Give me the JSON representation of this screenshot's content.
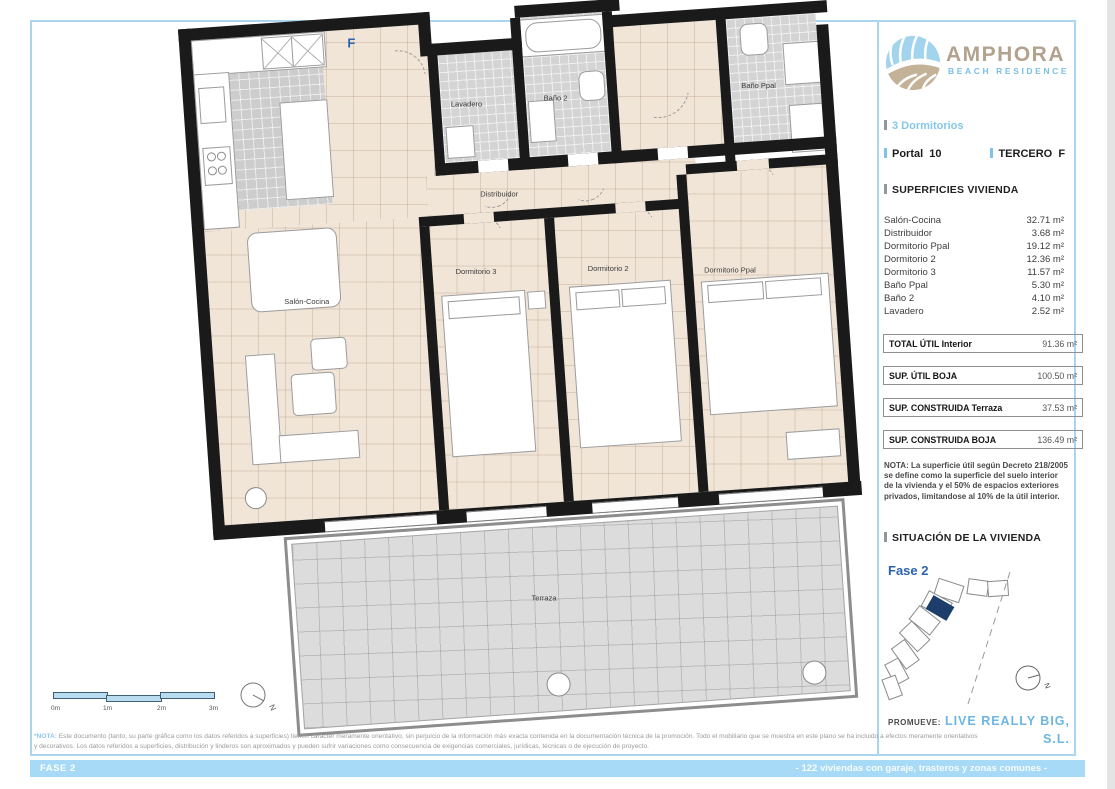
{
  "brand": {
    "name": "AMPHORA",
    "subtitle": "BEACH RESIDENCE"
  },
  "header": {
    "type": "3 Dormitorios",
    "portal": "Portal  10",
    "floor": "TERCERO  F"
  },
  "superficies": {
    "title": "SUPERFICIES VIVIENDA",
    "rows": [
      {
        "label": "Salón-Cocina",
        "value": "32.71 m²"
      },
      {
        "label": "Distribuidor",
        "value": "3.68 m²"
      },
      {
        "label": "Dormitorio Ppal",
        "value": "19.12 m²"
      },
      {
        "label": "Dormitorio 2",
        "value": "12.36 m²"
      },
      {
        "label": "Dormitorio 3",
        "value": "11.57 m²"
      },
      {
        "label": "Baño Ppal",
        "value": "5.30 m²"
      },
      {
        "label": "Baño 2",
        "value": "4.10 m²"
      },
      {
        "label": "Lavadero",
        "value": "2.52 m²"
      }
    ],
    "totals": [
      {
        "label": "TOTAL ÚTIL Interior",
        "value": "91.36 m²"
      },
      {
        "label": "SUP.  ÚTIL BOJA",
        "value": "100.50 m²"
      },
      {
        "label": "SUP. CONSTRUIDA Terraza",
        "value": "37.53 m²"
      },
      {
        "label": "SUP. CONSTRUIDA BOJA",
        "value": "136.49 m²"
      }
    ]
  },
  "nota": "NOTA: La superficie útil según Decreto 218/2005 se define como la superficie del suelo interior de la vivienda y el 50% de espacios exteriores privados, limitandose al 10% de la útil interior.",
  "situacion": {
    "title": "SITUACIÓN DE LA VIVIENDA",
    "fase": "Fase 2"
  },
  "promoter": {
    "label": "PROMUEVE:",
    "name": "LIVE REALLY BIG, S.L."
  },
  "plan": {
    "unit_letter": "F",
    "north_label": "N",
    "rooms": {
      "lavadero": "Lavadero",
      "bano2": "Baño 2",
      "bano_ppal": "Baño Ppal",
      "distribuidor": "Distribuidor",
      "salon_cocina": "Salón-Cocina",
      "dormitorio3": "Dormitorio 3",
      "dormitorio2": "Dormitorio 2",
      "dormitorio_ppal": "Dormitorio Ppal",
      "terraza": "Terraza"
    }
  },
  "scalebar": {
    "labels": [
      "0m",
      "1m",
      "2m",
      "3m"
    ]
  },
  "footer": {
    "note_prefix": "*NOTA:",
    "line1": " Este documento (tanto, su parte gráfica como los datos referidos a superficies) tienen carácter meramente orientativo, sin perjuicio de la información más exacta contenida en la documentación técnica de la promoción. Todo el mobiliario que se muestra en este plano se ha incluido a efectos meramente orientativos",
    "line2": "y decorativos. Los datos referidos a superficies, distribución y linderos son aproximados y pueden sufrir variaciones como consecuencia de exigencias comerciales, jurídicas, técnicas o de ejecución de proyecto.",
    "bar_left": "FASE 2",
    "bar_right": "- 122 viviendas con garaje, trasteros y zonas comunes -"
  },
  "colors": {
    "accent_blue": "#8ec9ea",
    "brand_tan": "#b3a28d",
    "dark_blue": "#2b63ae",
    "bar_blue": "#a6daf6",
    "highlight_navy": "#1d3e6b"
  }
}
